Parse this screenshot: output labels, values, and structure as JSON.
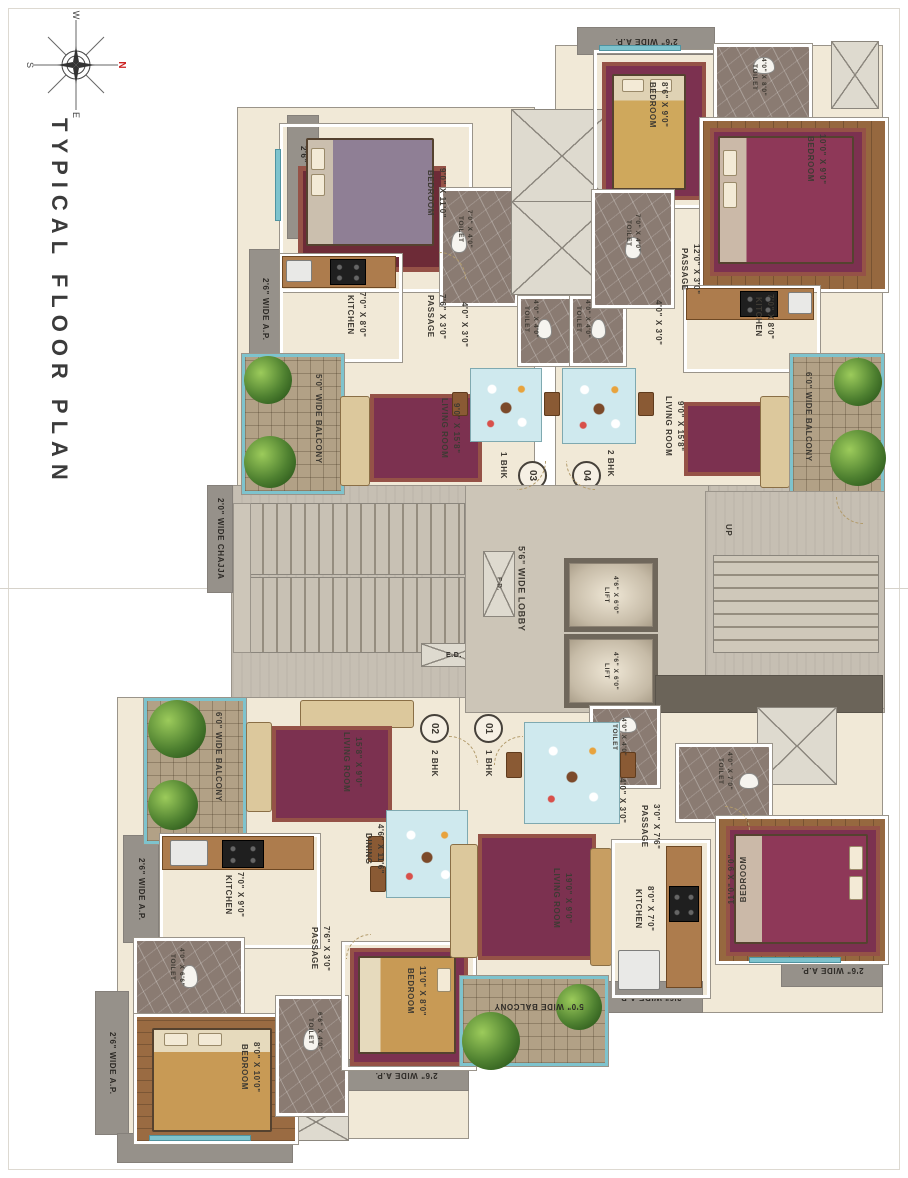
{
  "page": {
    "title": "TYPICAL FLOOR PLAN"
  },
  "compass": {
    "n": "N",
    "s": "S",
    "e": "E",
    "w": "W"
  },
  "units": {
    "u01": {
      "number": "01",
      "type": "1 BHK"
    },
    "u02": {
      "number": "02",
      "type": "2 BHK"
    },
    "u03": {
      "number": "03",
      "type": "1 BHK"
    },
    "u04": {
      "number": "04",
      "type": "2 BHK"
    }
  },
  "rooms": {
    "bedroom03": {
      "name": "BEDROOM",
      "dims": "9'0\" X 11'0\""
    },
    "toilet03": {
      "name": "TOILET",
      "dims": "7'0\" X 4'0\""
    },
    "kitchen03": {
      "name": "KITCHEN",
      "dims": "7'0\" X 8'0\""
    },
    "passage03": {
      "name": "PASSAGE",
      "dims": "7'6\" X 3'0\""
    },
    "seg03": {
      "dims": "4'0\" X 3'0\""
    },
    "toilet_c1": {
      "name": "TOILET",
      "dims": "4'0\" X 4'0\""
    },
    "toilet_c2": {
      "name": "TOILET",
      "dims": "4'0\" X 4'0\""
    },
    "living03": {
      "name": "LIVING ROOM",
      "dims": "9'0\" X 15'8\""
    },
    "balcony03": {
      "name": "5'0\" WIDE BALCONY"
    },
    "bedroom04a": {
      "name": "BEDROOM",
      "dims": "8'6\" X 9'0\""
    },
    "toilet04a": {
      "name": "TOILET",
      "dims": "4'0\" X 8'0\""
    },
    "bedroom04b": {
      "name": "BEDROOM",
      "dims": "10'0\" X 9'0\""
    },
    "toilet04b": {
      "name": "TOILET",
      "dims": "7'0\" X 4'0\""
    },
    "passage04": {
      "name": "PASSAGE",
      "dims": "12'0\" X 3'0\""
    },
    "seg04": {
      "dims": "4'0\" X 3'0\""
    },
    "kitchen04": {
      "name": "KITCHEN",
      "dims": "7'0\" X 8'0\""
    },
    "living04": {
      "name": "LIVING ROOM",
      "dims": "9'0\" X 15'8\""
    },
    "balcony04": {
      "name": "6'0\" WIDE BALCONY"
    },
    "living02": {
      "name": "LIVING ROOM",
      "dims": "15'8\" X 9'0\""
    },
    "dining02": {
      "name": "DINING",
      "dims": "4'6\" X 11'6\""
    },
    "kitchen02": {
      "name": "KITCHEN",
      "dims": "7'0\" X 9'0\""
    },
    "passage02": {
      "name": "PASSAGE",
      "dims": "7'6\" X 3'0\""
    },
    "toilet02a": {
      "name": "TOILET",
      "dims": "4'0\" X 6'6\""
    },
    "toilet02b": {
      "name": "TOILET",
      "dims": "6'6\" X 4'0\""
    },
    "bedroom02a": {
      "name": "BEDROOM",
      "dims": "8'0\" X 10'0\""
    },
    "bedroom02b": {
      "name": "BEDROOM",
      "dims": "11'0\" X 8'0\""
    },
    "balcony02": {
      "name": "6'0\" WIDE BALCONY"
    },
    "toilet01a": {
      "name": "TOILET",
      "dims": "4'0\" X 4'0\""
    },
    "seg01": {
      "dims": "4'0\" X 3'0\""
    },
    "passage01": {
      "name": "PASSAGE",
      "dims": "3'0\" X 7'6\""
    },
    "toilet01b": {
      "name": "TOILET",
      "dims": "4'0\" X 7'0\""
    },
    "living01": {
      "name": "LIVING ROOM",
      "dims": "19'0\" X 9'0\""
    },
    "kitchen01": {
      "name": "KITCHEN",
      "dims": "8'0\" X 7'0\""
    },
    "bedroom01": {
      "name": "BEDROOM",
      "dims": "11'0\" X 9'0\""
    },
    "balcony01": {
      "name": "5'0\" WIDE BALCONY"
    }
  },
  "core": {
    "lobby": "5'6\" WIDE LOBBY",
    "lift_name": "LIFT",
    "lift_dims": "4'6\" X 6'0\"",
    "up": "UP",
    "fd": "F.D.",
    "ed": "E.D."
  },
  "edges": {
    "ap": "2'6\" WIDE A.P.",
    "chajja": "2'0\" WIDE CHAJJA"
  },
  "palette": {
    "floor": "#f1e9d7",
    "concrete": "#c6bfb3",
    "marble_toilet": "#8a7b72",
    "balcony_rail": "#7ec3cd",
    "edge_bar": "#96918a"
  }
}
